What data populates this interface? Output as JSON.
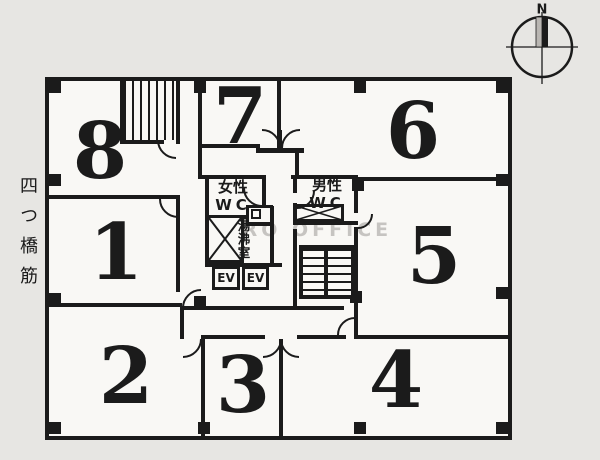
{
  "page": {
    "background": "#e7e6e3",
    "paper": "#f9f8f5",
    "ink": "#1b1b1b",
    "watermark_color": "#c6c4c1"
  },
  "street_label": {
    "text": "四つ橋筋"
  },
  "compass": {
    "north_label": "N"
  },
  "watermark": {
    "text": "ZERO OFFICE"
  },
  "rooms": [
    {
      "id": "room-1",
      "number": "1"
    },
    {
      "id": "room-2",
      "number": "2"
    },
    {
      "id": "room-3",
      "number": "3"
    },
    {
      "id": "room-4",
      "number": "4"
    },
    {
      "id": "room-5",
      "number": "5"
    },
    {
      "id": "room-6",
      "number": "6"
    },
    {
      "id": "room-7",
      "number": "7"
    },
    {
      "id": "room-8",
      "number": "8"
    }
  ],
  "core": {
    "womens_wc": {
      "line1": "女性",
      "line2": "WC"
    },
    "mens_wc": {
      "line1": "男性",
      "line2": "WC"
    },
    "kitchenette": {
      "label": "湯沸室"
    },
    "elevators": [
      {
        "label": "EV"
      },
      {
        "label": "EV"
      }
    ]
  }
}
